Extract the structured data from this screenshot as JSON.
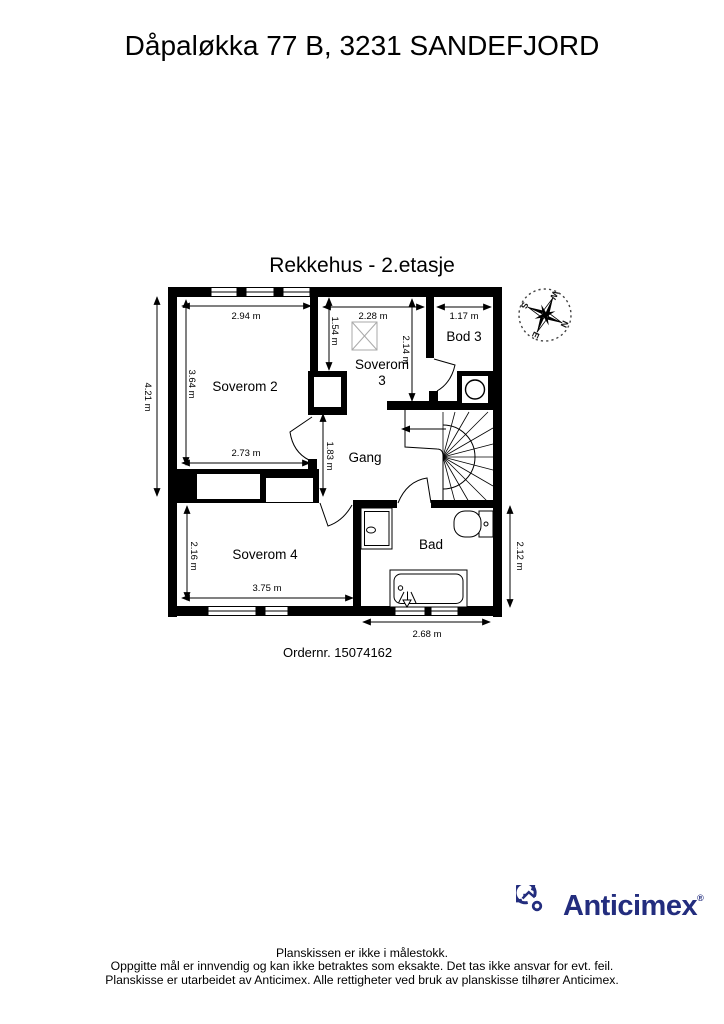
{
  "header": {
    "title": "Dåpaløkka 77 B, 3231 SANDEFJORD"
  },
  "plan": {
    "subtitle": "Rekkehus - 2.etasje",
    "order_number": "Ordernr. 15074162",
    "wall_color": "#000000",
    "compass_icon": "compass-rose-icon",
    "rooms": {
      "soverom2": "Soverom 2",
      "soverom3_line1": "Soverom",
      "soverom3_line2": "3",
      "bod3": "Bod 3",
      "gang": "Gang",
      "soverom4": "Soverom 4",
      "bad": "Bad"
    },
    "dimensions": {
      "soverom2_width_top": "2.94 m",
      "soverom2_height": "3.64 m",
      "soverom2_width_bottom": "2.73 m",
      "left_total_height": "4.21 m",
      "soverom3_height_left": "1.54 m",
      "soverom3_width": "2.28 m",
      "soverom3_height_right": "2.14 m",
      "bod3_width": "1.17 m",
      "gang_height": "1.83 m",
      "soverom4_height": "2.16 m",
      "soverom4_width": "3.75 m",
      "bad_height": "2.12 m",
      "bad_width": "2.68 m"
    },
    "compass": {
      "n": "N",
      "e": "E",
      "s": "S",
      "w": "W"
    }
  },
  "footer": {
    "logo_icon": "anticimex-swirl-house-icon",
    "logo_text": "Anticimex",
    "logo_mark": "®",
    "brand_color": "#232d7e",
    "disclaimer_line1": "Planskissen er ikke i målestokk.",
    "disclaimer_line2": "Oppgitte mål er innvendig og kan ikke betraktes som eksakte. Det tas ikke ansvar for evt. feil.",
    "disclaimer_line3": "Planskisse er utarbeidet av Anticimex. Alle rettigheter ved bruk av planskisse tilhører Anticimex."
  }
}
